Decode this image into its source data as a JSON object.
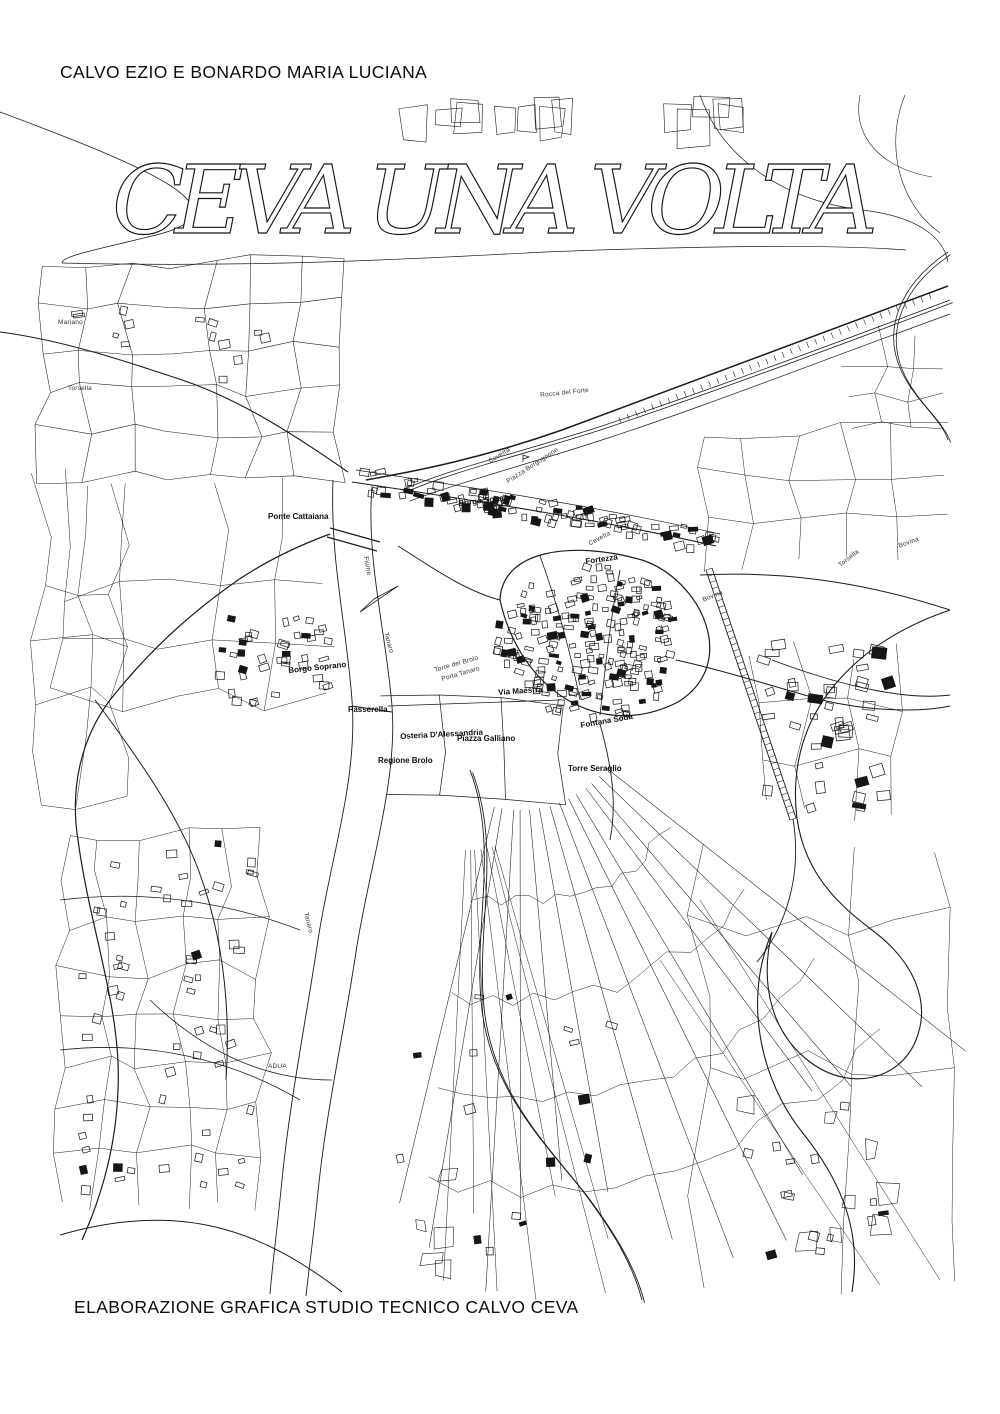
{
  "page": {
    "author_line": "CALVO EZIO E BONARDO MARIA LUCIANA",
    "title": "CEVA UNA VOLTA",
    "credit_line": "ELABORAZIONE GRAFICA STUDIO TECNICO CALVO CEVA"
  },
  "map": {
    "ink_color": "#1c1c1c",
    "background_color": "#ffffff",
    "labels": [
      {
        "text": "Mariano",
        "x": 58,
        "y": 320,
        "rot": 0,
        "cls": "tiny"
      },
      {
        "text": "Torsella",
        "x": 68,
        "y": 386,
        "rot": 0,
        "cls": "tiny"
      },
      {
        "text": "Rocca del Forte",
        "x": 540,
        "y": 393,
        "rot": -6,
        "cls": "tiny"
      },
      {
        "text": "Cevetta",
        "x": 488,
        "y": 460,
        "rot": -32,
        "cls": "tiny"
      },
      {
        "text": "Piazza Borgognone",
        "x": 506,
        "y": 480,
        "rot": -33,
        "cls": "tiny"
      },
      {
        "text": "Borgo Sottano",
        "x": 458,
        "y": 500,
        "rot": -7,
        "cls": "bold"
      },
      {
        "text": "Ponte Cattaiana",
        "x": 268,
        "y": 513,
        "rot": 0,
        "cls": "bold"
      },
      {
        "text": "Cevetta",
        "x": 588,
        "y": 542,
        "rot": -28,
        "cls": "tiny"
      },
      {
        "text": "Bovina",
        "x": 898,
        "y": 544,
        "rot": -20,
        "cls": "tiny"
      },
      {
        "text": "Torsella",
        "x": 838,
        "y": 564,
        "rot": -38,
        "cls": "tiny"
      },
      {
        "text": "Fortezza",
        "x": 585,
        "y": 558,
        "rot": -8,
        "cls": "bold"
      },
      {
        "text": "Fiume",
        "x": 368,
        "y": 556,
        "rot": 80,
        "cls": "tiny"
      },
      {
        "text": "Bovina",
        "x": 702,
        "y": 598,
        "rot": -22,
        "cls": "tiny"
      },
      {
        "text": "Tanaro",
        "x": 388,
        "y": 632,
        "rot": 74,
        "cls": "tiny"
      },
      {
        "text": "Borgo Soprano",
        "x": 288,
        "y": 667,
        "rot": -6,
        "cls": "bold"
      },
      {
        "text": "Torre del Brolo",
        "x": 434,
        "y": 668,
        "rot": -16,
        "cls": "tiny"
      },
      {
        "text": "Porta Tanaro",
        "x": 441,
        "y": 677,
        "rot": -16,
        "cls": "tiny"
      },
      {
        "text": "Via Maestra",
        "x": 498,
        "y": 689,
        "rot": -4,
        "cls": "bold"
      },
      {
        "text": "Passerella",
        "x": 348,
        "y": 706,
        "rot": 0,
        "cls": "bold"
      },
      {
        "text": "Fontana Soda",
        "x": 580,
        "y": 722,
        "rot": -10,
        "cls": "bold"
      },
      {
        "text": "Osteria D'Alessandria",
        "x": 400,
        "y": 733,
        "rot": -3,
        "cls": "bold"
      },
      {
        "text": "Piazza Galliano",
        "x": 457,
        "y": 735,
        "rot": 0,
        "cls": "bold"
      },
      {
        "text": "Regione Brolo",
        "x": 378,
        "y": 757,
        "rot": 0,
        "cls": "bold"
      },
      {
        "text": "Torre Seraglio",
        "x": 568,
        "y": 765,
        "rot": 0,
        "cls": "bold"
      },
      {
        "text": "Tanaro",
        "x": 308,
        "y": 912,
        "rot": 76,
        "cls": "tiny"
      },
      {
        "text": "ADUA",
        "x": 268,
        "y": 1064,
        "rot": 0,
        "cls": "tiny"
      }
    ]
  }
}
